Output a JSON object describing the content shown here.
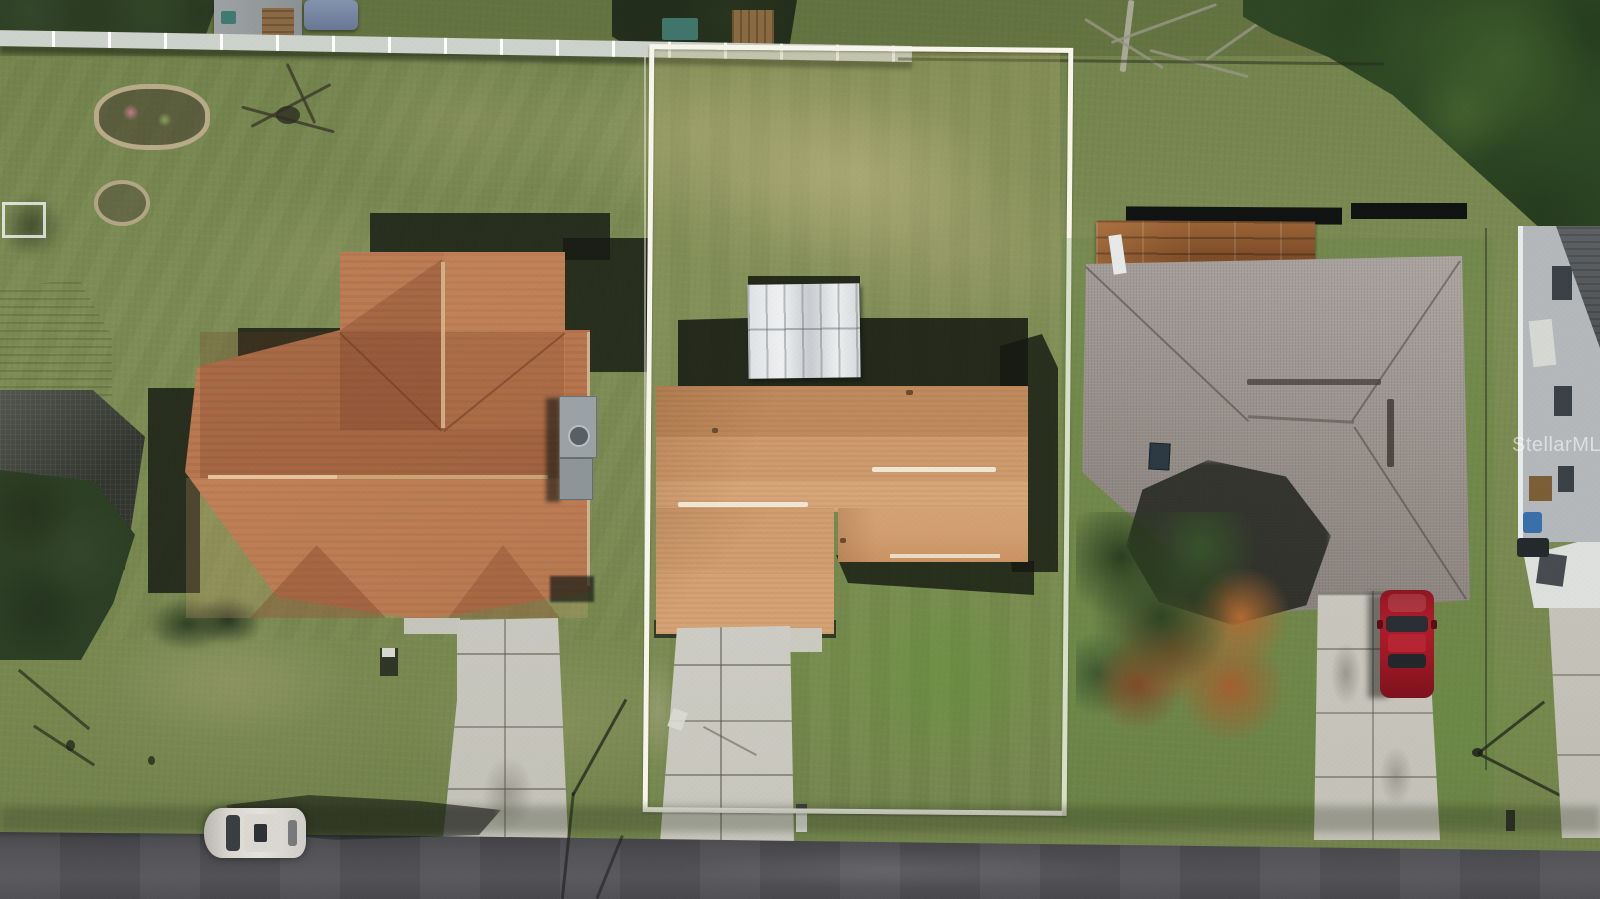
{
  "image": {
    "kind": "aerial-real-estate-photo",
    "width_px": 1600,
    "height_px": 899,
    "description": "Top-down drone photo of three suburban homes along an asphalt street. The middle lot is highlighted with a white property-boundary rectangle: patchy lawn, L-shaped house with orange-tan shingle roof, white metal shed behind it, cracked concrete driveway to the road. Left home has a T-shaped brown shingle roof; right home has a large gray hip roof with a copper metal section, a colorful tree, and a red car in its driveway. A white car is parked on the road at lower left."
  },
  "watermark": {
    "text": "StellarMLS"
  },
  "property_outline": {
    "shape": "rectangle",
    "color": "#f8f6ec"
  },
  "palette": {
    "grass": "#7c8b52",
    "dry_grass": "#b0ab7c",
    "road": "#47474b",
    "left_roof": "#b8764e",
    "center_roof": "#cf9b6d",
    "right_roof": "#9d9590",
    "copper_roof": "#7c4b28",
    "concrete": "#cbcac1",
    "shadow": "#1c201a",
    "tree_dark_green": "#2e4624",
    "tree_rust": "#9c5a2c",
    "red_car": "#a01825",
    "white_car": "#d9d7d0",
    "metal_shed": "#e9ebea",
    "vinyl_fence": "#cdd3cc"
  },
  "objects": [
    "white vinyl fence along back of lots",
    "wire fence on right rear boundary",
    "flower bed rings in left backyard",
    "screened enclosure of neighbor at left edge",
    "AC unit beside left house",
    "white metal shed behind center house",
    "skylight on right roof",
    "utility pole shadows",
    "mailboxes at street",
    "red car in right driveway",
    "white car parked on street"
  ]
}
